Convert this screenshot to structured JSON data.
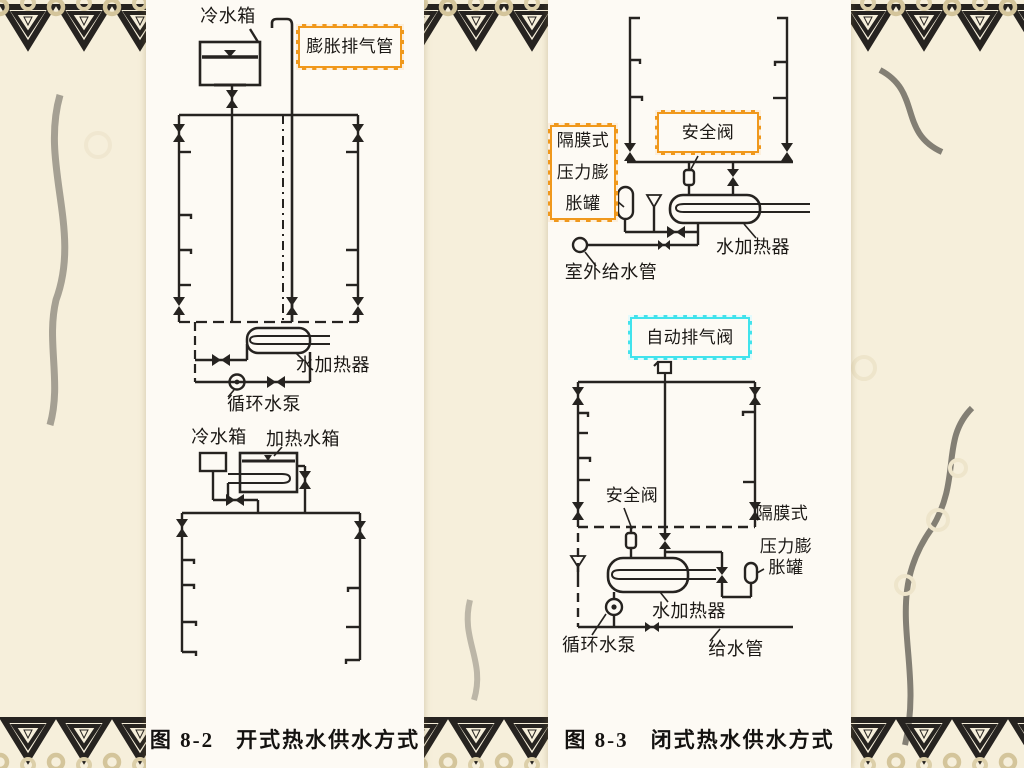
{
  "slide": {
    "bg": "#f6efdb",
    "panel_bg": "#fdfaf4",
    "border_pattern_color": "#d4c59b",
    "ink": "#262320",
    "highlight_orange": "#f0981c",
    "highlight_cyan": "#41e3ec"
  },
  "left_figure": {
    "labels": {
      "cold_tank_top": "冷水箱",
      "expansion_vent_pipe": "膨胀排气管",
      "water_heater": "水加热器",
      "circ_pump": "循环水泵",
      "cold_tank_lower": "冷水箱",
      "heating_tank": "加热水箱"
    },
    "caption_fig": "图 8-2",
    "caption_title": "开式热水供水方式"
  },
  "right_figure": {
    "labels": {
      "diaphragm_line1": "隔膜式",
      "diaphragm_line2": "压力膨",
      "diaphragm_line3": "胀罐",
      "safety_valve_top": "安全阀",
      "water_heater_top": "水加热器",
      "outdoor_supply_pipe": "室外给水管",
      "auto_air_vent": "自动排气阀",
      "safety_valve_lower": "安全阀",
      "diaphragm2_line1": "隔膜式",
      "diaphragm2_line2": "压力膨",
      "diaphragm2_line3": "胀罐",
      "water_heater_lower": "水加热器",
      "circ_pump": "循环水泵",
      "supply_pipe": "给水管"
    },
    "caption_fig": "图 8-3",
    "caption_title": "闭式热水供水方式"
  }
}
